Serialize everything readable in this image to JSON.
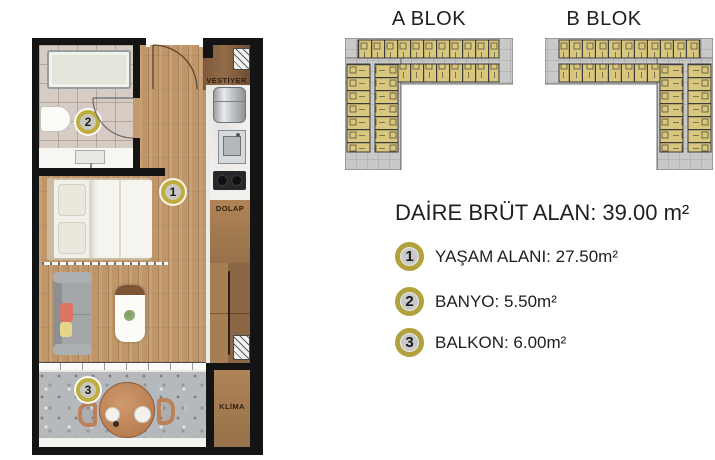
{
  "floor_plan": {
    "labels": {
      "vestiyer": "VESTİYER",
      "dolap": "DOLAP",
      "klima": "KLİMA"
    },
    "markers": {
      "living": "1",
      "bath": "2",
      "balcony": "3"
    }
  },
  "blocks": {
    "a_title": "A BLOK",
    "b_title": "B BLOK"
  },
  "info": {
    "area_title": "DAİRE BRÜT ALAN: 39.00 m²",
    "legend": [
      {
        "num": "1",
        "label": "YAŞAM ALANI: 27.50m²"
      },
      {
        "num": "2",
        "label": "BANYO: 5.50m²"
      },
      {
        "num": "3",
        "label": "BALKON: 6.00m²"
      }
    ]
  },
  "colors": {
    "unit_fill": "#d9c77d",
    "carcass_gray": "#c7c7c7",
    "marker_ring": "#bfae3e",
    "wall": "#141414",
    "wood_floor": "#c09668"
  }
}
